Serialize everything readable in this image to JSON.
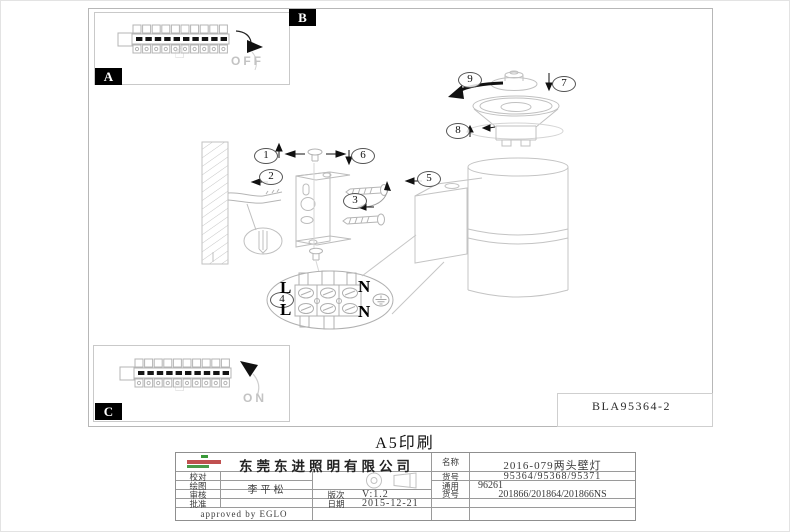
{
  "page": {
    "print_title": "A5印刷",
    "drawing_number": "BLA95364-2"
  },
  "drawing": {
    "detail_labels": {
      "a": "A",
      "b": "B",
      "c": "C"
    },
    "callouts": [
      "1",
      "2",
      "3",
      "4",
      "5",
      "6",
      "7",
      "8",
      "9"
    ],
    "switch_off_label": "OFF",
    "switch_on_label": "ON",
    "terminal_labels": [
      "L",
      "N",
      "L",
      "N"
    ]
  },
  "title_block": {
    "company": "东莞东进照明有限公司",
    "fields": {
      "check_label": "校对",
      "draw_label": "绘图",
      "draw_value": "李平松",
      "review_label": "审核",
      "approve_label": "批准",
      "revision_label": "版次",
      "revision_value": "V:1.2",
      "date_label": "日期",
      "date_value": "2015-12-21",
      "name_label": "名称",
      "name_value": "2016-079两头壁灯",
      "item_label": "货号",
      "item_value": "95364/95368/95371",
      "common_label_line1": "通用",
      "common_label_line2": "货号",
      "common_value_line1": "96261",
      "common_value_line2": "201866/201864/201866NS"
    },
    "approved_note": "approved by EGLO"
  }
}
